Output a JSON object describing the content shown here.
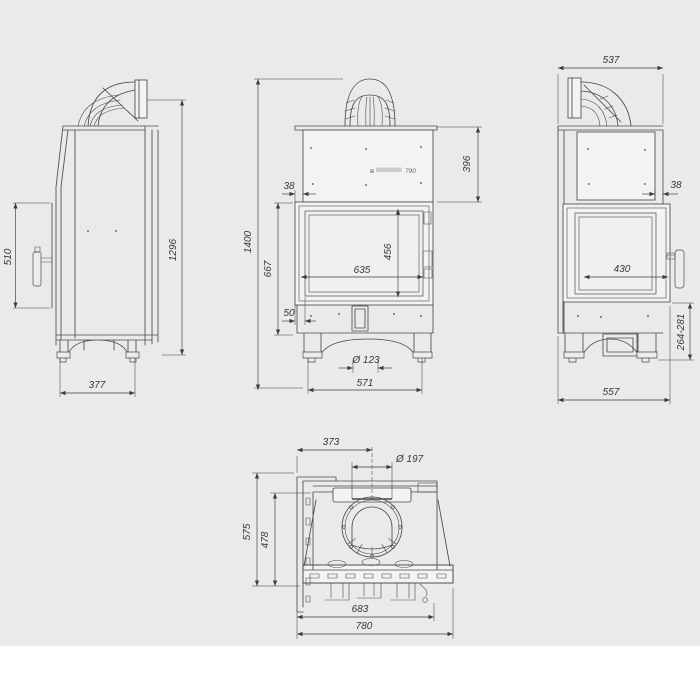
{
  "page": {
    "background": "#e9eaeb",
    "bottom_strip": "#ffffff"
  },
  "brand": {
    "mark": "⊕",
    "model": "790"
  },
  "dims": {
    "left": {
      "glass_height": "510",
      "height": "1296",
      "depth": "377"
    },
    "front": {
      "overall_height": "1400",
      "body_height": "667",
      "hood_height": "396",
      "offset_top": "38",
      "glass_width": "635",
      "glass_height": "456",
      "offset_bottom": "50",
      "hole_diameter": "Ø 123",
      "base_width": "571"
    },
    "right": {
      "depth": "537",
      "offset_front": "38",
      "glass_width": "430",
      "feet_range": "264-281",
      "base_depth": "557"
    },
    "top": {
      "flue_offset": "373",
      "flue_diameter": "Ø 197",
      "depth": "575",
      "inner_depth": "478",
      "inner_width": "683",
      "overall_width": "780"
    }
  }
}
